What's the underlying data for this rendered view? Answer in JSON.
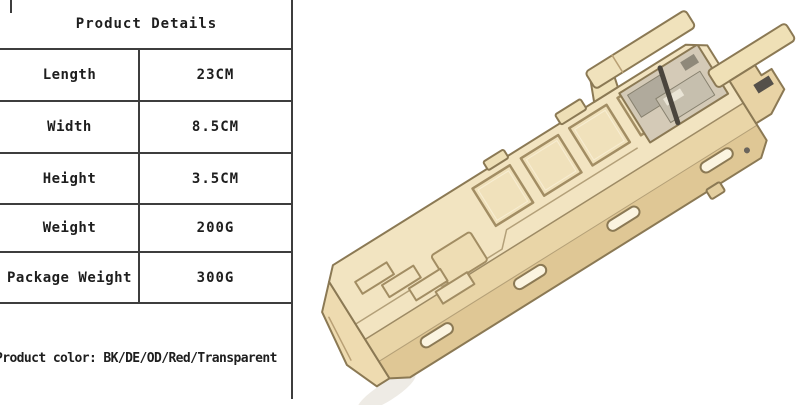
{
  "table": {
    "title": "Product Details",
    "rows": [
      {
        "label": "Length",
        "value": "23CM"
      },
      {
        "label": "Width",
        "value": "8.5CM"
      },
      {
        "label": "Height",
        "value": "3.5CM"
      },
      {
        "label": "Weight",
        "value": "200G"
      },
      {
        "label": "Package Weight",
        "value": "300G"
      }
    ],
    "color_note": "Product color: BK/DE/OD/Red/Transparent"
  },
  "product_image": {
    "alt": "tan tactical magazine case viewed at an angle",
    "colors": {
      "body": "#e8d4a6",
      "top_face": "#f2e4c1",
      "mid_face": "#e9d5a7",
      "side_face": "#dfc795",
      "outline": "#8b7954",
      "engrave": "#a28d63",
      "inner_gray": "#b0aa9c",
      "inner_plate": "#c6bfae",
      "dark_accent": "#4a453d",
      "background": "#ffffff"
    }
  }
}
